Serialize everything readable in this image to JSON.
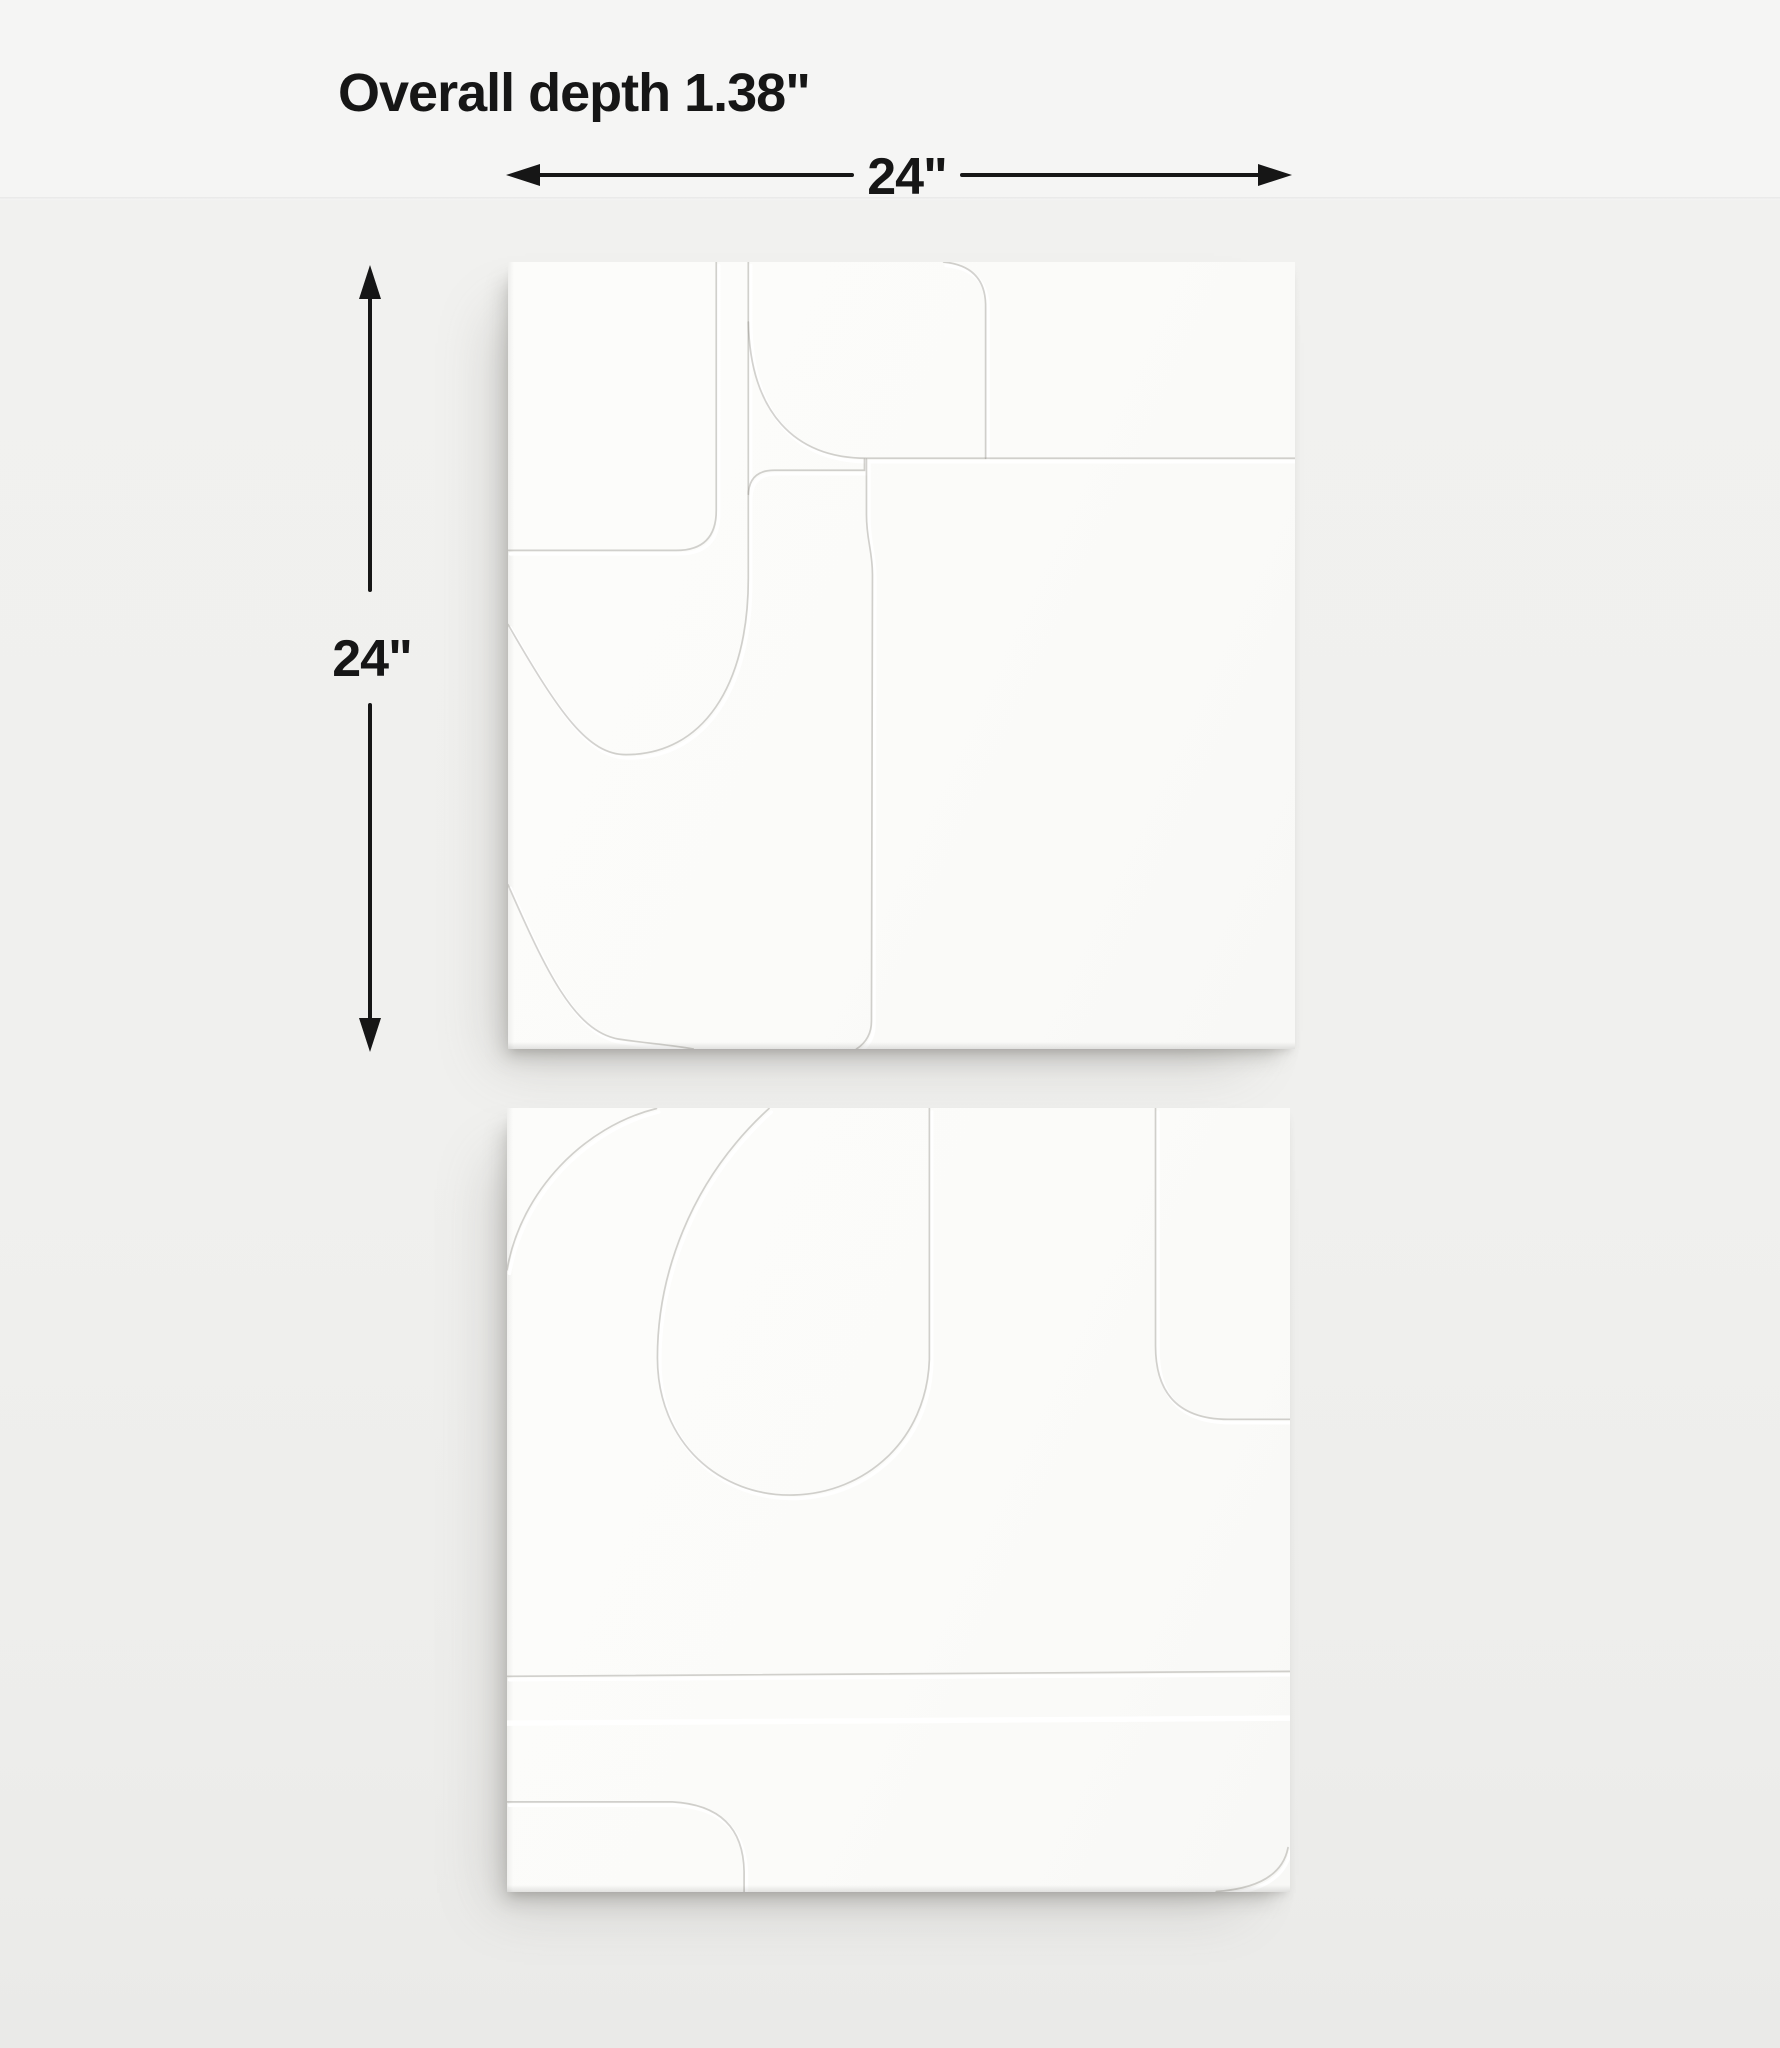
{
  "annotations": {
    "depth": "Overall depth 1.38\"",
    "width": "24\"",
    "height": "24\""
  },
  "artwork": {
    "panel_count": 2,
    "panels": [
      {
        "name": "top panel",
        "shape": "square white geometric relief"
      },
      {
        "name": "bottom panel",
        "shape": "square white geometric relief"
      }
    ]
  },
  "colors": {
    "background_top": "#f5f5f4",
    "background": "#f0f0ee",
    "panel_face": "#fbfbf9",
    "annotation_ink": "#161616",
    "shadow": "#d9d9d7"
  }
}
